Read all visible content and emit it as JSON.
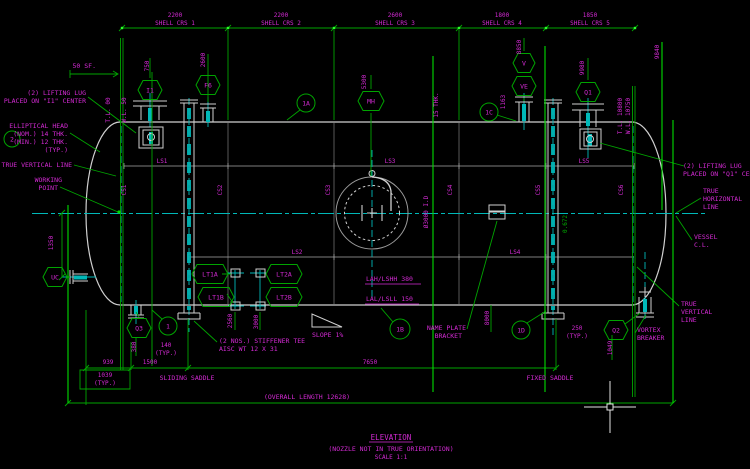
{
  "colors": {
    "bg": "#000000",
    "mg": "#d42ad4",
    "gr": "#00a400",
    "br": "#00dc00",
    "cy": "#00b8b8",
    "wh": "#d0d0d0",
    "gy": "#7d7d7d",
    "grip": "#2bff2b"
  },
  "title_block": {
    "title": "ELEVATION",
    "subtitle": "(NOZZLE NOT IN TRUE ORIENTATION)",
    "scale": "SCALE 1:1"
  },
  "top_dims": [
    {
      "value": "2200",
      "label": "SHELL CRS 1",
      "cx": 175
    },
    {
      "value": "2200",
      "label": "SHELL CRS 2",
      "cx": 281
    },
    {
      "value": "2600",
      "label": "SHELL CRS 3",
      "cx": 395
    },
    {
      "value": "1800",
      "label": "SHELL CRS 4",
      "cx": 502
    },
    {
      "value": "1850",
      "label": "SHELL CRS 5",
      "cx": 590
    }
  ],
  "hex_tags": [
    {
      "id": "i1",
      "t": "I1",
      "x": 150,
      "y": 90,
      "w": 24
    },
    {
      "id": "f6",
      "t": "F6",
      "x": 208,
      "y": 85,
      "w": 24
    },
    {
      "id": "mh",
      "t": "MH",
      "x": 371,
      "y": 101,
      "w": 26
    },
    {
      "id": "v",
      "t": "V",
      "x": 524,
      "y": 63,
      "w": 22
    },
    {
      "id": "ve",
      "t": "VE",
      "x": 524,
      "y": 86,
      "w": 24
    },
    {
      "id": "q1",
      "t": "Q1",
      "x": 588,
      "y": 92,
      "w": 24
    },
    {
      "id": "uc",
      "t": "UC",
      "x": 55,
      "y": 277,
      "w": 24
    },
    {
      "id": "q3",
      "t": "Q3",
      "x": 139,
      "y": 328,
      "w": 24
    },
    {
      "id": "q2",
      "t": "Q2",
      "x": 616,
      "y": 330,
      "w": 24
    },
    {
      "id": "lt1a",
      "t": "LT1A",
      "x": 210,
      "y": 274,
      "w": 36
    },
    {
      "id": "lt1b",
      "t": "LT1B",
      "x": 216,
      "y": 297,
      "w": 36
    },
    {
      "id": "lt2a",
      "t": "LT2A",
      "x": 284,
      "y": 274,
      "w": 36
    },
    {
      "id": "lt2b",
      "t": "LT2B",
      "x": 284,
      "y": 297,
      "w": 36
    }
  ],
  "balloons": [
    {
      "id": "2",
      "t": "2",
      "x": 12,
      "y": 139,
      "r": 8
    },
    {
      "id": "1a",
      "t": "1A",
      "x": 306,
      "y": 103,
      "r": 9
    },
    {
      "id": "1",
      "t": "1",
      "x": 168,
      "y": 326,
      "r": 9
    },
    {
      "id": "1b",
      "t": "1B",
      "x": 400,
      "y": 329,
      "r": 10
    },
    {
      "id": "1c",
      "t": "1C",
      "x": 489,
      "y": 112,
      "r": 9
    },
    {
      "id": "1d",
      "t": "1D",
      "x": 521,
      "y": 330,
      "r": 9
    }
  ],
  "texts": [
    {
      "id": "lug-left-1",
      "t": "(2) LIFTING LUG",
      "x": 86,
      "y": 95,
      "a": "e"
    },
    {
      "id": "lug-left-2",
      "t": "PLACED ON \"I1\" CENTER",
      "x": 86,
      "y": 103,
      "a": "e"
    },
    {
      "id": "head-note-1",
      "t": "ELLIPTICAL HEAD",
      "x": 68,
      "y": 128,
      "a": "e"
    },
    {
      "id": "head-note-2",
      "t": "(NOM.) 14 THK.",
      "x": 68,
      "y": 136,
      "a": "e"
    },
    {
      "id": "head-note-3",
      "t": "(MIN.) 12 THK.",
      "x": 68,
      "y": 144,
      "a": "e"
    },
    {
      "id": "head-note-4",
      "t": "(TYP.)",
      "x": 68,
      "y": 152,
      "a": "e"
    },
    {
      "id": "true-vertical-left",
      "t": "TRUE VERTICAL LINE",
      "x": 72,
      "y": 167,
      "a": "e"
    },
    {
      "id": "working-1",
      "t": "WORKING",
      "x": 62,
      "y": 182,
      "a": "e"
    },
    {
      "id": "working-2",
      "t": "POINT",
      "x": 58,
      "y": 190,
      "a": "e"
    },
    {
      "id": "sf-50",
      "t": "50 SF.",
      "x": 96,
      "y": 68,
      "a": "e"
    },
    {
      "id": "tl-left",
      "t": "T.L. 00",
      "x": 110,
      "y": 110,
      "r": -90,
      "fs": 6
    },
    {
      "id": "wl-left",
      "t": "W.L. 50",
      "x": 126,
      "y": 110,
      "r": -90,
      "fs": 6
    },
    {
      "id": "dim-750",
      "t": "750",
      "x": 149,
      "y": 66,
      "r": -90,
      "fs": 6
    },
    {
      "id": "dim-2600",
      "t": "2600",
      "x": 205,
      "y": 60,
      "r": -90,
      "fs": 6
    },
    {
      "id": "dim-5300",
      "t": "5300",
      "x": 366,
      "y": 82,
      "r": -90,
      "fs": 6
    },
    {
      "id": "dim-8850",
      "t": "8850",
      "x": 521,
      "y": 47,
      "r": -90,
      "fs": 6
    },
    {
      "id": "dim-9980",
      "t": "9980",
      "x": 584,
      "y": 68,
      "r": -90,
      "fs": 6
    },
    {
      "id": "dim-9840",
      "t": "9840",
      "x": 659,
      "y": 52,
      "r": -90,
      "fs": 6
    },
    {
      "id": "tl-right",
      "t": "T.L. 10800",
      "x": 622,
      "y": 116,
      "r": -90,
      "fs": 6
    },
    {
      "id": "wl-right",
      "t": "W.L. 10750",
      "x": 630,
      "y": 116,
      "r": -90,
      "fs": 6
    },
    {
      "id": "dim-1163",
      "t": "1163",
      "x": 505,
      "y": 102,
      "r": -90,
      "fs": 6
    },
    {
      "id": "lug-right-1",
      "t": "(2) LIFTING LUG",
      "x": 683,
      "y": 168,
      "a": "s"
    },
    {
      "id": "lug-right-2",
      "t": "PLACED ON \"Q1\" CENTER",
      "x": 683,
      "y": 176,
      "a": "s"
    },
    {
      "id": "true-horiz-1",
      "t": "TRUE",
      "x": 703,
      "y": 193,
      "a": "s"
    },
    {
      "id": "true-horiz-2",
      "t": "HORIZONTAL",
      "x": 703,
      "y": 201,
      "a": "s"
    },
    {
      "id": "true-horiz-3",
      "t": "LINE",
      "x": 703,
      "y": 209,
      "a": "s"
    },
    {
      "id": "vessel-cl-1",
      "t": "VESSEL",
      "x": 694,
      "y": 239,
      "a": "s"
    },
    {
      "id": "vessel-cl-2",
      "t": "C.L.",
      "x": 694,
      "y": 247,
      "a": "s"
    },
    {
      "id": "true-vert-r1",
      "t": "TRUE",
      "x": 681,
      "y": 306,
      "a": "s"
    },
    {
      "id": "true-vert-r2",
      "t": "VERTICAL",
      "x": 681,
      "y": 314,
      "a": "s"
    },
    {
      "id": "true-vert-r3",
      "t": "LINE",
      "x": 681,
      "y": 322,
      "a": "s"
    },
    {
      "id": "vortex-1",
      "t": "VORTEX",
      "x": 637,
      "y": 332,
      "a": "s"
    },
    {
      "id": "vortex-2",
      "t": "BREAKER",
      "x": 637,
      "y": 340,
      "a": "s"
    },
    {
      "id": "nameplate-1",
      "t": "NAME PLATE",
      "x": 466,
      "y": 330,
      "a": "e"
    },
    {
      "id": "nameplate-2",
      "t": "BRACKET",
      "x": 462,
      "y": 338,
      "a": "e"
    },
    {
      "id": "stiffener-1",
      "t": "(2 NOS.) STIFFENER TEE",
      "x": 219,
      "y": 343,
      "a": "s"
    },
    {
      "id": "stiffener-2",
      "t": "AISC WT 12 X 31",
      "x": 219,
      "y": 351,
      "a": "s"
    },
    {
      "id": "slope",
      "t": "SLOPE 1%",
      "x": 312,
      "y": 337,
      "a": "s"
    },
    {
      "id": "lah",
      "t": "LAH/LSHH  380",
      "x": 366,
      "y": 281,
      "a": "s"
    },
    {
      "id": "lal",
      "t": "LAL/LSLL  150",
      "x": 366,
      "y": 301,
      "a": "s"
    },
    {
      "id": "sliding-saddle",
      "t": "SLIDING SADDLE",
      "x": 187,
      "y": 380,
      "a": "m"
    },
    {
      "id": "fixed-saddle",
      "t": "FIXED SADDLE",
      "x": 550,
      "y": 380,
      "a": "m"
    },
    {
      "id": "overall-length",
      "t": "(OVERALL LENGTH 12628)",
      "x": 307,
      "y": 399,
      "a": "m"
    },
    {
      "id": "dim-939",
      "t": "939",
      "x": 108,
      "y": 364,
      "a": "m",
      "fs": 6
    },
    {
      "id": "dim-1500",
      "t": "1500",
      "x": 150,
      "y": 364,
      "a": "m",
      "fs": 6
    },
    {
      "id": "dim-7650",
      "t": "7650",
      "x": 370,
      "y": 364,
      "a": "m",
      "fs": 6
    },
    {
      "id": "dim-1039a",
      "t": "1039",
      "x": 105,
      "y": 377,
      "a": "m",
      "fs": 6
    },
    {
      "id": "dim-1039b",
      "t": "(TYP.)",
      "x": 105,
      "y": 385,
      "a": "m",
      "fs": 6
    },
    {
      "id": "dim-140a",
      "t": "140",
      "x": 166,
      "y": 347,
      "a": "m",
      "fs": 6
    },
    {
      "id": "dim-140b",
      "t": "(TYP.)",
      "x": 166,
      "y": 355,
      "a": "m",
      "fs": 6
    },
    {
      "id": "dim-250a",
      "t": "250",
      "x": 577,
      "y": 330,
      "a": "m",
      "fs": 6
    },
    {
      "id": "dim-250b",
      "t": "(TYP.)",
      "x": 577,
      "y": 338,
      "a": "m",
      "fs": 6
    },
    {
      "id": "dim-380",
      "t": "380",
      "x": 136,
      "y": 347,
      "r": -90,
      "fs": 6
    },
    {
      "id": "dim-1049",
      "t": "1049",
      "x": 612,
      "y": 348,
      "r": -90,
      "fs": 6
    },
    {
      "id": "dim-2560",
      "t": "2560",
      "x": 232,
      "y": 321,
      "r": -90,
      "fs": 6
    },
    {
      "id": "dim-3000",
      "t": "3000",
      "x": 258,
      "y": 322,
      "r": -90,
      "fs": 6
    },
    {
      "id": "dim-8000",
      "t": "8000",
      "x": 489,
      "y": 318,
      "r": -90,
      "fs": 6
    },
    {
      "id": "dim-1350",
      "t": "1350",
      "x": 53,
      "y": 243,
      "r": -90,
      "fs": 6
    },
    {
      "id": "id-3000",
      "t": "Ø3000 I.D",
      "x": 428,
      "y": 212,
      "r": -90,
      "fs": 6
    },
    {
      "id": "thk-15",
      "t": "15 THK.",
      "x": 438,
      "y": 105,
      "r": -90,
      "fs": 6
    },
    {
      "id": "dim-0672",
      "t": "0.672",
      "x": 567,
      "y": 224,
      "r": -90,
      "fs": 6,
      "c": "gr"
    },
    {
      "id": "ls1",
      "t": "LS1",
      "x": 162,
      "y": 163,
      "a": "m",
      "fs": 6
    },
    {
      "id": "ls2",
      "t": "LS2",
      "x": 297,
      "y": 254,
      "a": "m",
      "fs": 6
    },
    {
      "id": "ls3",
      "t": "LS3",
      "x": 390,
      "y": 163,
      "a": "m",
      "fs": 6
    },
    {
      "id": "ls4",
      "t": "LS4",
      "x": 515,
      "y": 254,
      "a": "m",
      "fs": 6
    },
    {
      "id": "ls5",
      "t": "LS5",
      "x": 584,
      "y": 163,
      "a": "m",
      "fs": 6
    },
    {
      "id": "cs1",
      "t": "CS1",
      "x": 126,
      "y": 190,
      "r": -90,
      "fs": 6
    },
    {
      "id": "cs2",
      "t": "CS2",
      "x": 222,
      "y": 190,
      "r": -90,
      "fs": 6
    },
    {
      "id": "cs3",
      "t": "CS3",
      "x": 330,
      "y": 190,
      "r": -90,
      "fs": 6
    },
    {
      "id": "cs4",
      "t": "CS4",
      "x": 452,
      "y": 190,
      "r": -90,
      "fs": 6
    },
    {
      "id": "cs5",
      "t": "CS5",
      "x": 540,
      "y": 190,
      "r": -90,
      "fs": 6
    },
    {
      "id": "cs6",
      "t": "CS6",
      "x": 623,
      "y": 190,
      "r": -90,
      "fs": 6
    },
    {
      "id": "title",
      "t": "ELEVATION",
      "x": 391,
      "y": 440,
      "a": "m",
      "fs": 7.5
    },
    {
      "id": "subtitle",
      "t": "(NOZZLE NOT IN TRUE ORIENTATION)",
      "x": 391,
      "y": 451,
      "a": "m",
      "fs": 6.5
    },
    {
      "id": "scale",
      "t": "SCALE 1:1",
      "x": 391,
      "y": 459,
      "a": "m",
      "fs": 6
    }
  ]
}
